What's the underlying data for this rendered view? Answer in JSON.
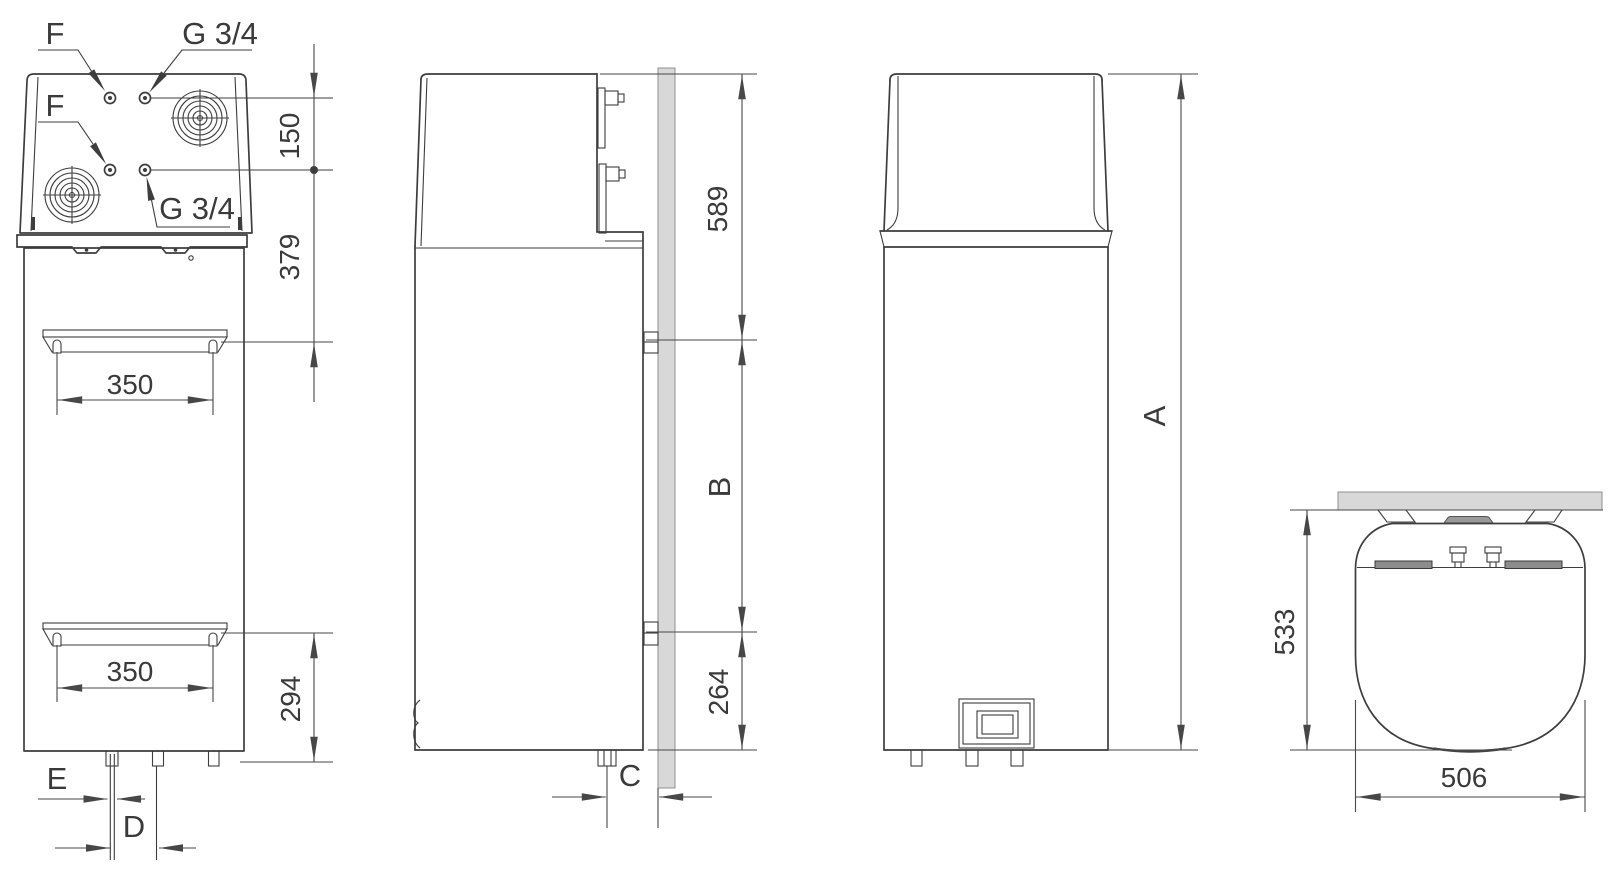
{
  "drawing": {
    "kind": "appliance-installation-dimension-drawing",
    "views": {
      "front": {
        "port_labels": {
          "f_top": "F",
          "g_top": "G 3/4",
          "f_mid": "F",
          "g_mid": "G 3/4"
        },
        "dims": {
          "port_offset": "150",
          "port_to_bracket": "379",
          "bracket_width_upper": "350",
          "bracket_width_lower": "350",
          "bracket_to_base": "294",
          "drain_pipe": "E",
          "pipe_pitch": "D"
        }
      },
      "side": {
        "dims": {
          "top_to_upper_bracket": "589",
          "bracket_pitch": "B",
          "lower_bracket_to_base": "264",
          "pipe_to_wall": "C"
        }
      },
      "rear": {
        "dims": {
          "overall_height": "A"
        }
      },
      "top": {
        "dims": {
          "depth_from_wall": "533",
          "overall_width": "506"
        }
      }
    },
    "colors": {
      "line": "#3d3d3d",
      "dimension_line": "#474747",
      "wall_fill": "#d8d8d8",
      "wall_edge": "#909090",
      "bracket_bar_fill": "#8c8c8c",
      "top_cap_fill": "#9a9a9a",
      "background": "#ffffff"
    }
  }
}
